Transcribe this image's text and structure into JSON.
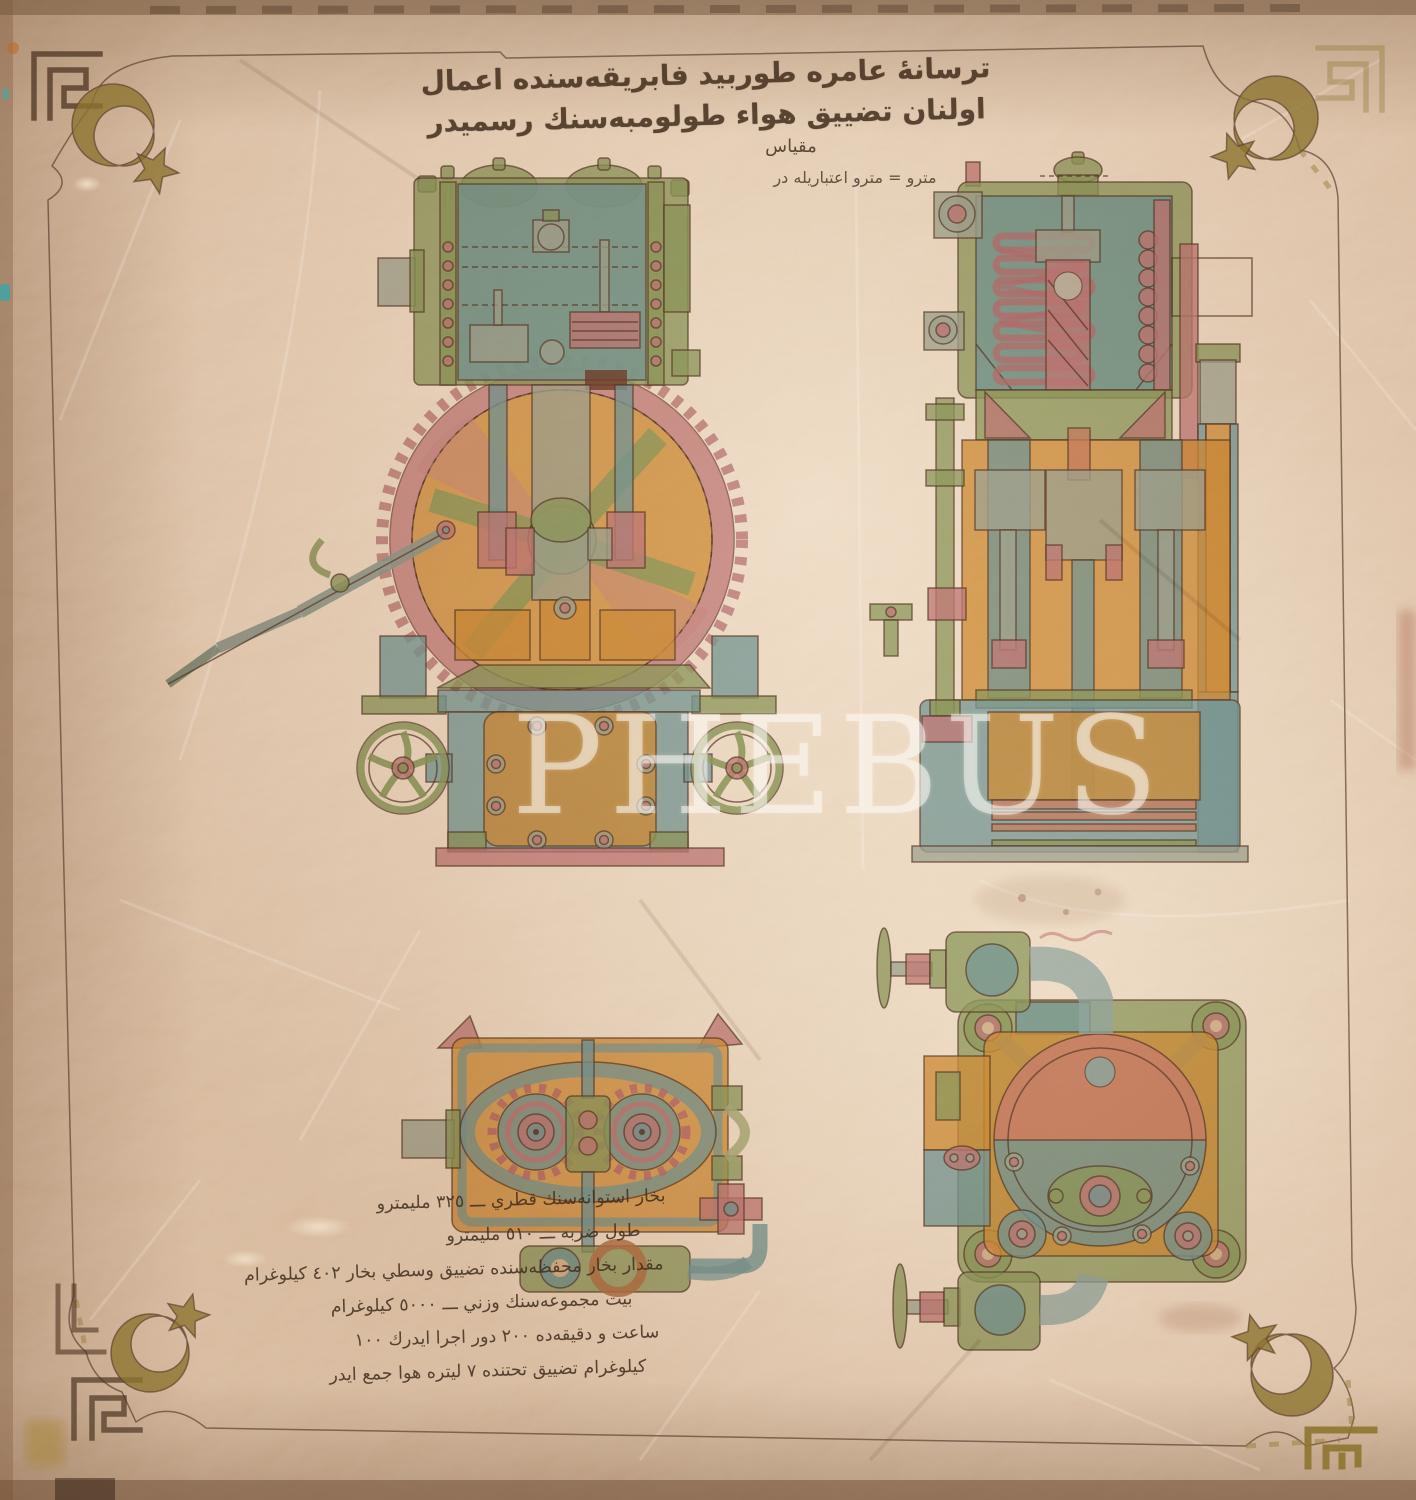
{
  "title": {
    "calligraphy": "ترسانهٔ عامره طوربيد فابريقه‌سنده اعمال اولنان تضييق هواء طولومبه‌سنك رسميدر"
  },
  "scale": {
    "heading": "مقياس",
    "note": "مترو = مترو اعتباريله در"
  },
  "specs": {
    "lines": [
      "بخار استوانه‌سنك قطري ـــ ٣٢٥ مليمترو",
      "طول ضربه ـــ ٥١٠ مليمترو",
      "مقدار بخار محفظه‌سنده تضييق وسطي بخار ٤٠٢ كيلوغرام",
      "بيت مجموعه‌سنك وزني ـــ ٥٠٠٠ كيلوغرام",
      "ساعت و دقيقه‌ده ٢٠٠ دور اجرا ايدرك ١٠٠",
      "كيلوغرام تضييق تحتنده ٧ ليتره هوا جمع ايدر"
    ]
  },
  "watermark": {
    "text": "PHEBUS"
  },
  "decorations": {
    "corner_motif_icon": "crescent-and-star-icon",
    "border_motif_icon": "greek-key-meander-icon",
    "corner_count": 4
  },
  "palette": {
    "paper": "#cfa783",
    "paper_light": "#ecd3b4",
    "ink": "#5d4130",
    "green": "#9bb47a",
    "blue": "#83b2c1",
    "pink": "#cf8f9b",
    "orange": "#dfa64c",
    "salmon": "#d9967e",
    "gold": "#8d742f",
    "watermark_white": "rgba(253,250,243,0.52)"
  }
}
